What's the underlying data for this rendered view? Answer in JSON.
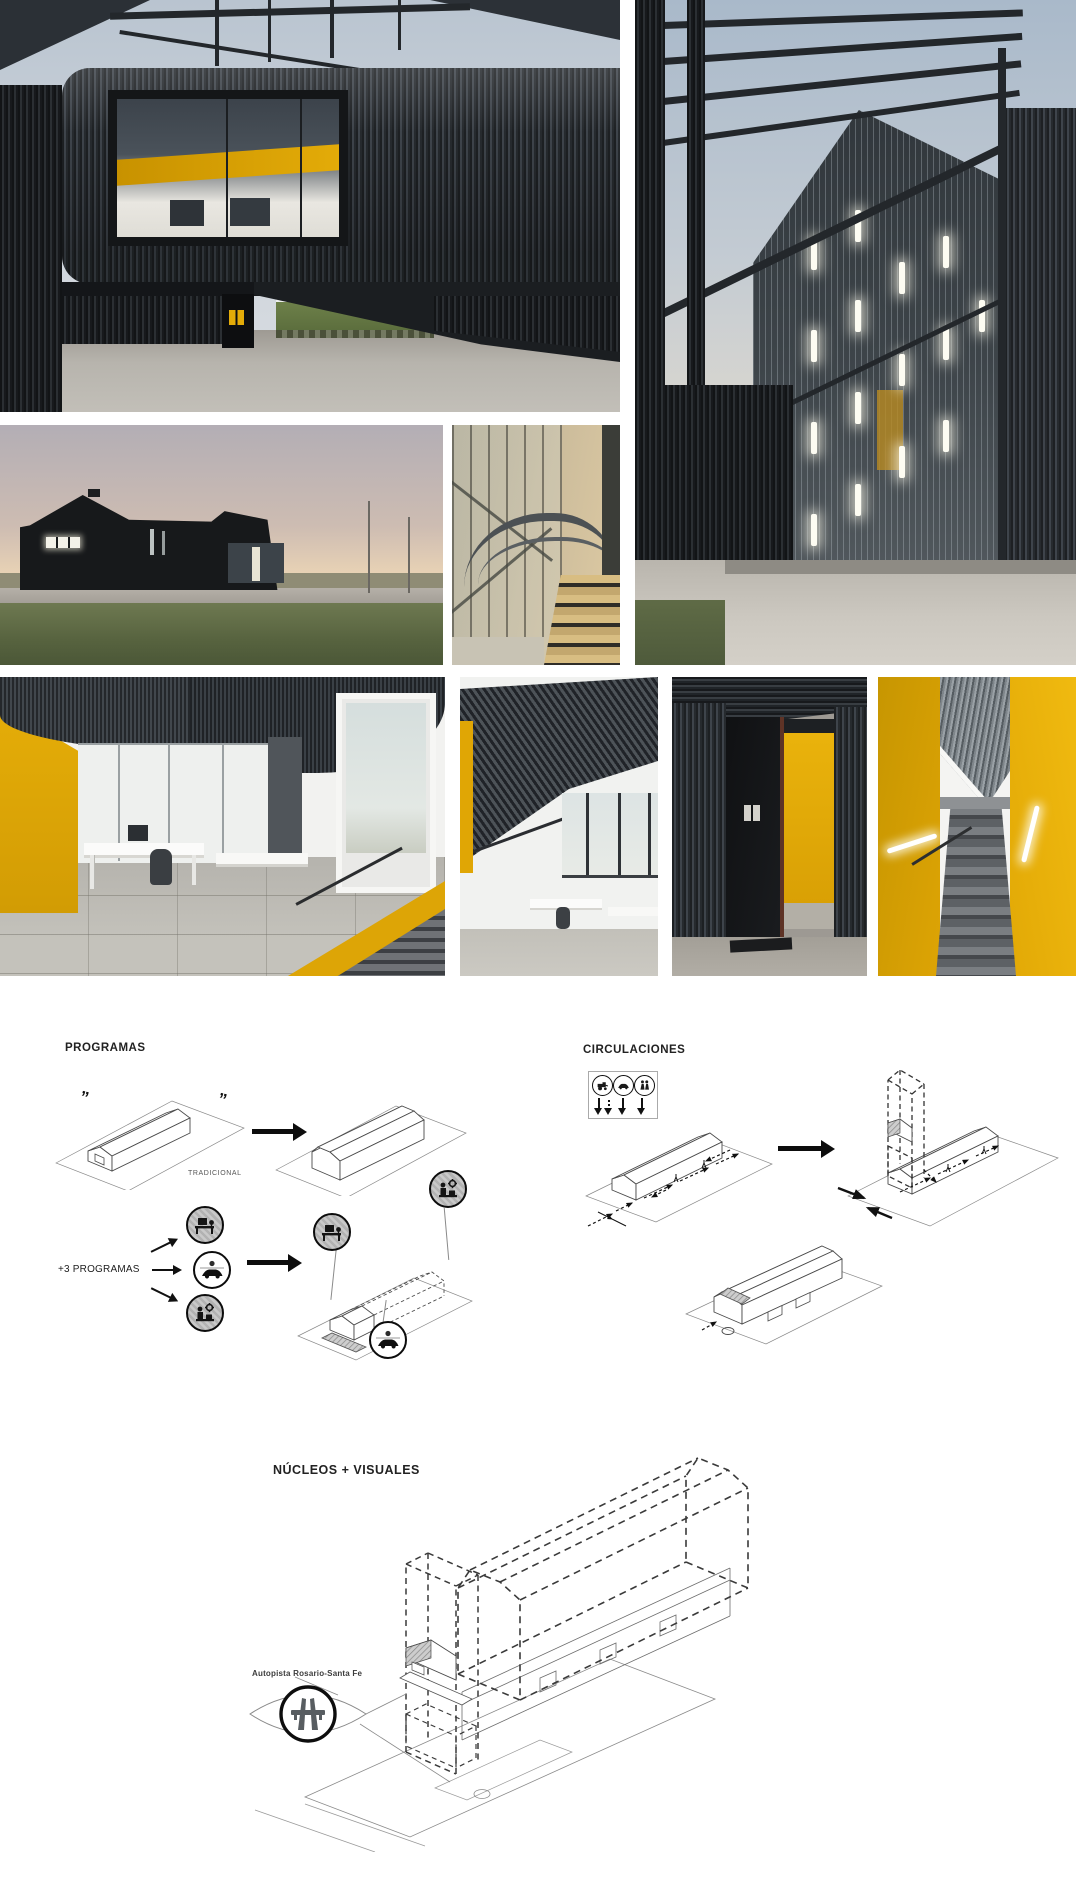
{
  "page": {
    "title": "architecture presentation board"
  },
  "colors": {
    "accent_yellow": "#E2A606",
    "dark_metal": "#202428",
    "diagram_line": "#4a4a4a",
    "sky": "#c3cdd8"
  },
  "gallery": {
    "photos": [
      {
        "id": "facade-window",
        "label": "black corrugated facade with large picture window over open undercroft"
      },
      {
        "id": "corner-dusk",
        "label": "building corner at dusk with steel pergola and glowing polycarbonate wall"
      },
      {
        "id": "exterior-sunset",
        "label": "black gabled shed exterior at sunset"
      },
      {
        "id": "stairwell-glass",
        "label": "glazed stairwell with curved rail"
      },
      {
        "id": "office-yellow-wall",
        "label": "open office with yellow wall and perforated ceiling"
      },
      {
        "id": "office-double-height",
        "label": "double height office under sloping perforated ceiling"
      },
      {
        "id": "entry-black-door",
        "label": "black entry door opening to yellow corridor"
      },
      {
        "id": "stair-yellow-walls",
        "label": "stair rising between yellow walls"
      }
    ]
  },
  "diagrams": {
    "programas": {
      "title": "PROGRAMAS",
      "quote_left": "”",
      "quote_right": "”",
      "tradicional_label": "TRADICIONAL",
      "plus_programas_label": "+3 PROGRAMAS",
      "program_icons": [
        "workspace-icon",
        "car-icon",
        "workshop-icon"
      ]
    },
    "circulaciones": {
      "title": "CIRCULACIONES",
      "legend_icons": [
        "harvester-icon",
        "car-icon",
        "people-icon"
      ]
    },
    "nucleos": {
      "title": "NÚCLEOS + VISUALES",
      "autopista_label": "Autopista Rosario-Santa Fe",
      "icon": "highway-icon"
    }
  }
}
